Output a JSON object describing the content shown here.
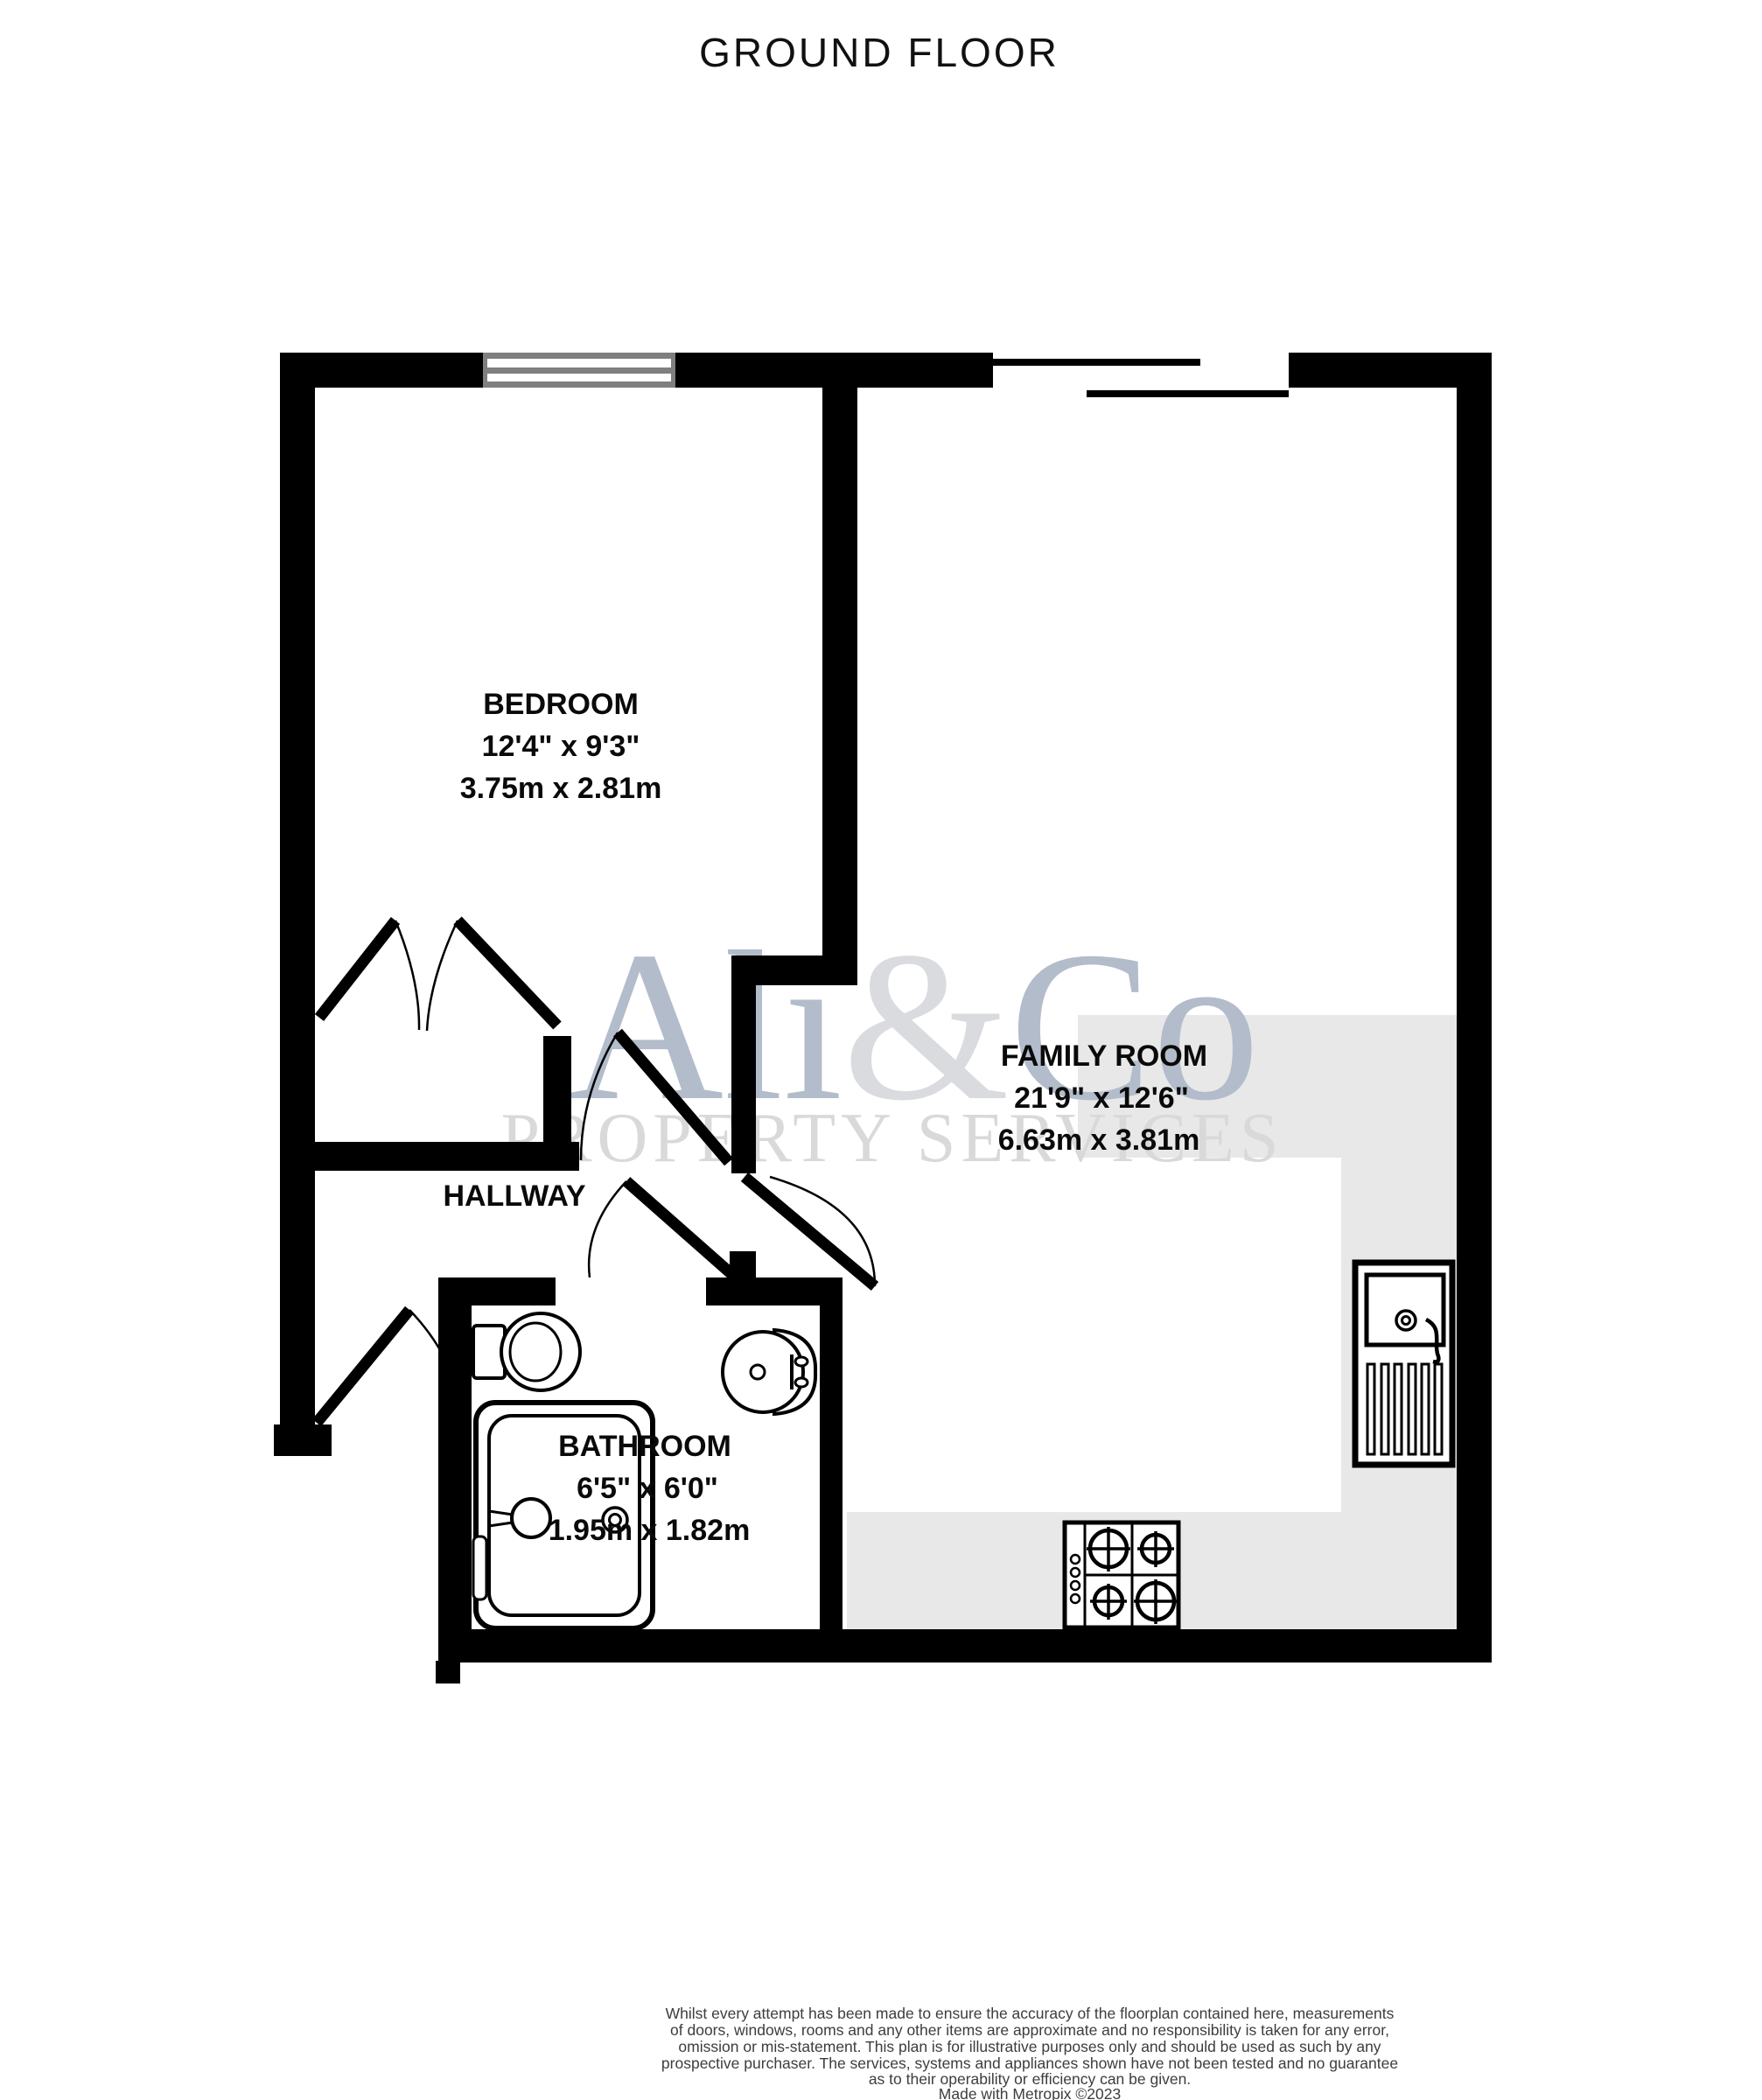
{
  "title": "GROUND FLOOR",
  "watermark": {
    "brand_part1": "Ali",
    "brand_amp": "&",
    "brand_part2": "Co",
    "subtitle": "PROPERTY SERVICES"
  },
  "rooms": {
    "bedroom": {
      "name": "BEDROOM",
      "imperial": "12'4\" x 9'3\"",
      "metric": "3.75m x 2.81m"
    },
    "family_room": {
      "name": "FAMILY ROOM",
      "imperial": "21'9\" x 12'6\"",
      "metric": "6.63m x 3.81m"
    },
    "hallway": {
      "name": "HALLWAY"
    },
    "bathroom": {
      "name": "BATHROOM",
      "imperial": "6'5\" x 6'0\"",
      "metric": "1.95m x 1.82m"
    }
  },
  "fixtures": [
    "toilet",
    "bathroom-sink",
    "bathtub",
    "kitchen-sink",
    "hob"
  ],
  "disclaimer": {
    "lines": [
      "Whilst every attempt has been made to ensure the accuracy of the floorplan contained here, measurements",
      "of doors, windows, rooms and any other items are approximate and no responsibility is taken for any error,",
      "omission or mis-statement. This plan is for illustrative purposes only and should be used as such by any",
      "prospective purchaser. The services, systems and appliances shown have not been tested and no guarantee",
      "as to their operability or efficiency can be given.",
      "Made with Metropix ©2023"
    ]
  },
  "colors": {
    "wall": "#000000",
    "floor_gray": "#e8e8e8",
    "window_gray": "#7f7f7f",
    "watermark_blue": "#b3bcca",
    "watermark_light": "#d9dbde",
    "watermark_sub_gray": "#d9d9d9",
    "disclaimer_text": "#3d3d3d"
  }
}
